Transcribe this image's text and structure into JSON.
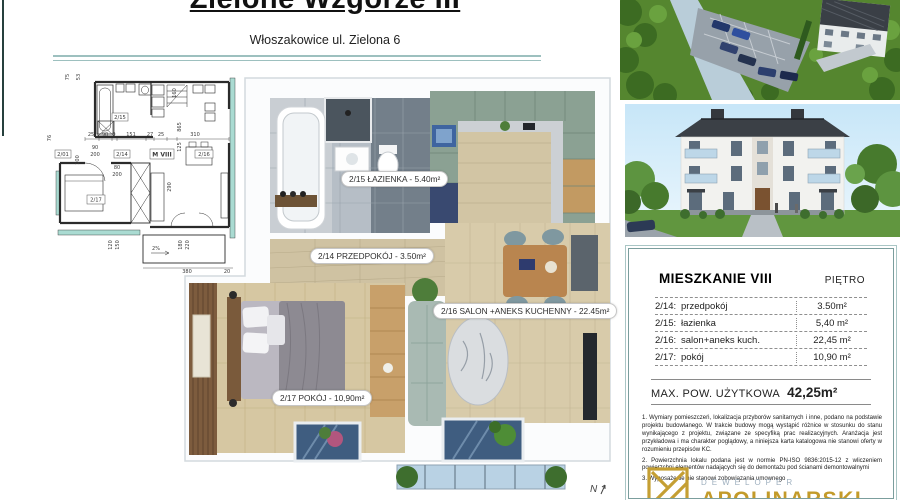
{
  "header": {
    "title": "Zielone Wzgórze III",
    "subtitle": "Włoszakowice ul. Zielona 6"
  },
  "tech_plan": {
    "unit": "M VIII",
    "rooms": {
      "r201": "2/01",
      "r214": "2/14",
      "r215": "2/15",
      "r216": "2/16",
      "r217": "2/17"
    },
    "dims": [
      "75",
      "53",
      "76",
      "100",
      "90",
      "200",
      "25",
      "90",
      "9",
      "151",
      "27",
      "25",
      "310",
      "160",
      "865",
      "125",
      "80",
      "200",
      "290",
      "120",
      "150",
      "2%",
      "180",
      "220",
      "380",
      "20"
    ]
  },
  "floor_plan": {
    "labels": [
      {
        "text": "2/15 ŁAZIENKA - 5.40m²"
      },
      {
        "text": "2/14  PRZEDPOKÓJ - 3.50m²"
      },
      {
        "text": "2/16  SALON +ANEKS KUCHENNY - 22.45m²"
      },
      {
        "text": "2/17  POKÓJ - 10,90m²"
      }
    ],
    "compass": "N"
  },
  "info_card": {
    "title": "MIESZKANIE VIII",
    "floor": "PIĘTRO",
    "rows": [
      {
        "code": "2/14:",
        "name": "przedpokój",
        "area": "3.50m²"
      },
      {
        "code": "2/15:",
        "name": "łazienka",
        "area": "5,40 m²"
      },
      {
        "code": "2/16:",
        "name": "salon+aneks kuch.",
        "area": "22,45 m²"
      },
      {
        "code": "2/17:",
        "name": "pokój",
        "area": "10,90 m²"
      }
    ],
    "total_label": "MAX. POW. UŻYTKOWA",
    "total_value": "42,25m²",
    "disclaimers": [
      "1. Wymiary pomieszczeń, lokalizacja przyborów sanitarnych i inne, podano na podstawie projektu budowlanego. W trakcie budowy mogą wystąpić różnice w stosunku do stanu wynikającego z projektu, związane ze specyfiką prac realizacyjnych. Aranżacja jest przykładowa i ma charakter poglądowy, a niniejsza karta katalogowa nie stanowi oferty w rozumieniu przepisów KC.",
      "2. Powierzchnia lokalu podana jest w normie PN-ISO 9836:2015-12 z wliczeniem powierzchni elementów nadających się do demontażu pod ścianami demontowalnymi",
      "3. Wyposażenie nie stanowi zobowiązania umownego"
    ],
    "brand": {
      "top": "DEWELOPER",
      "name": "APOLINARSKI"
    }
  }
}
